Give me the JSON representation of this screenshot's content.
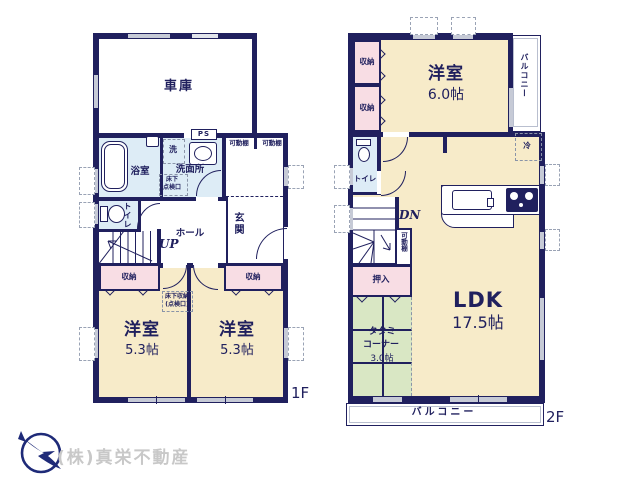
{
  "colors": {
    "wall_navy": "#20205e",
    "room_cream": "#f7ebc9",
    "closet_pink": "#f8dde4",
    "wet_blue": "#ddecf6",
    "tatami_green": "#d9e7c4",
    "window_gray": "#c6cad6",
    "logo_navy": "#1e2a78",
    "logo_gray": "#c8c8c8"
  },
  "f1": {
    "floor": "1F",
    "garage": "車庫",
    "bath": "浴室",
    "washroom": "洗面所",
    "washer": "洗",
    "ps": "PS",
    "hatch1": "床下",
    "hatch2": "点検口",
    "shelf_l": "可動棚",
    "shelf_r": "可動棚",
    "toilet": "トイレ",
    "hall": "ホール",
    "up": "UP",
    "entrance": "玄関",
    "closet_l": "収納",
    "closet_r": "収納",
    "uf1": "床下収納",
    "uf2": "(点検口)",
    "bed_l_name": "洋室",
    "bed_l_size": "5.3帖",
    "bed_r_name": "洋室",
    "bed_r_size": "5.3帖"
  },
  "f2": {
    "floor": "2F",
    "closet_t": "収納",
    "closet_b": "収納",
    "bed_name": "洋室",
    "bed_size": "6.0帖",
    "balcony_side": "バルコニー",
    "toilet": "トイレ",
    "fridge": "冷",
    "dn": "DN",
    "shelf": "可動棚",
    "oshiire": "押入",
    "tatami1": "タタミ",
    "tatami2": "コーナー",
    "tatami3": "3.0帖",
    "ldk_name": "LDK",
    "ldk_size": "17.5帖",
    "balcony_bottom": "バルコニー"
  },
  "logo": {
    "company": "(株)真栄不動産"
  }
}
